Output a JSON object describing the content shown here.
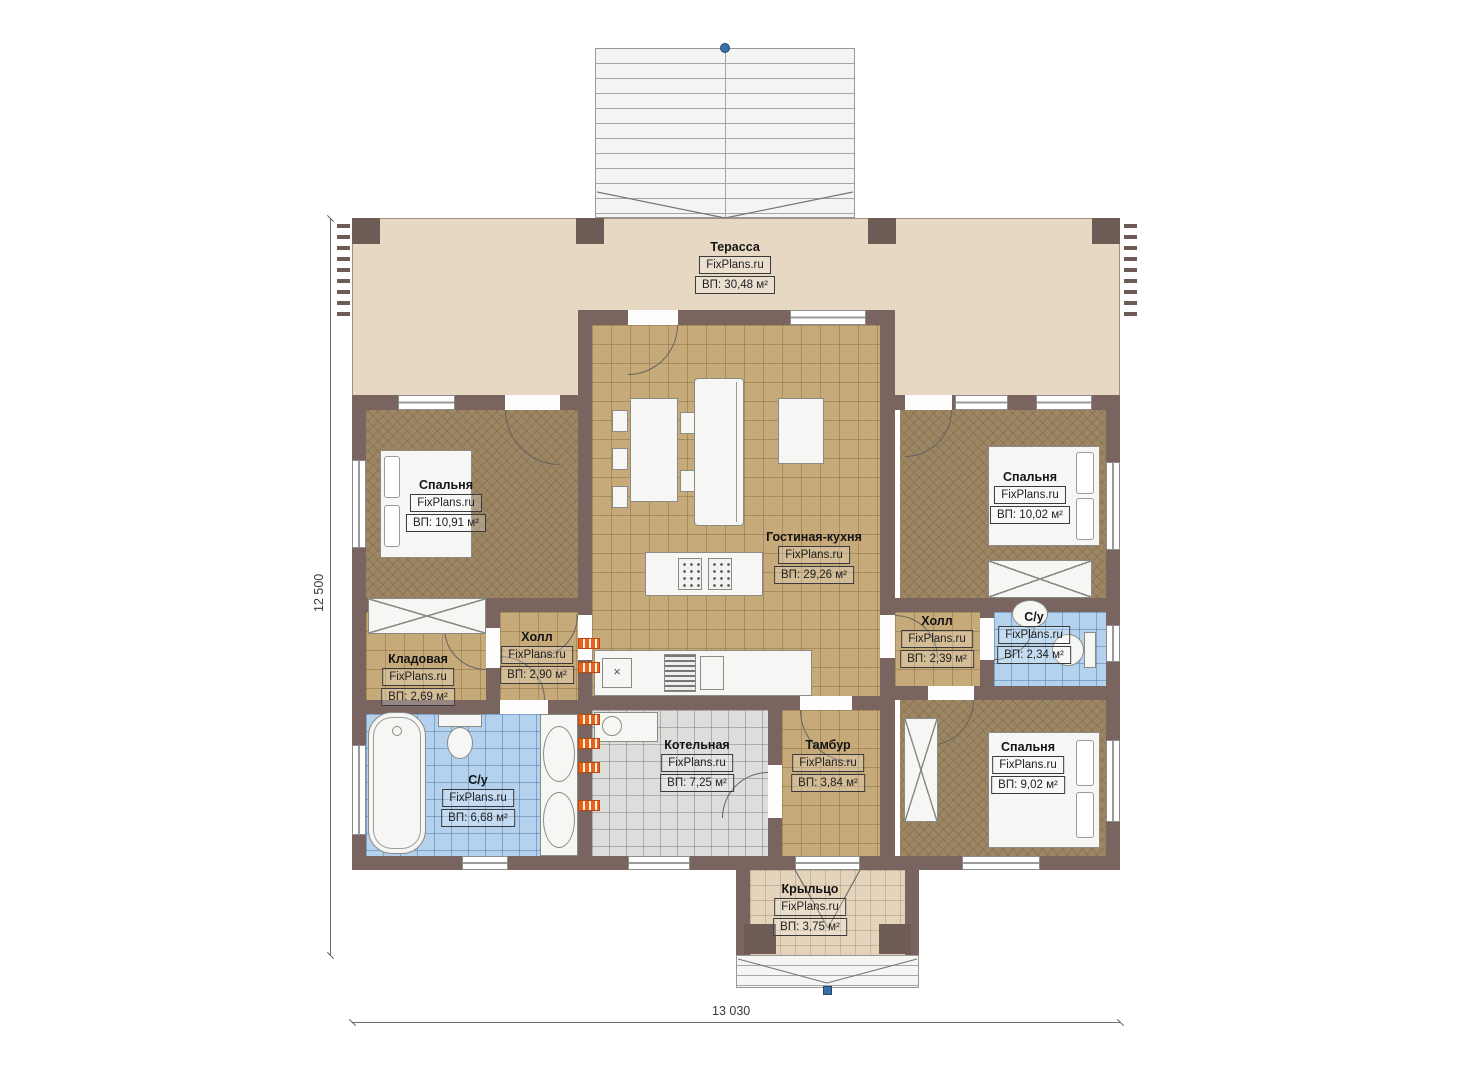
{
  "plan": {
    "watermark": "FixPlans.ru",
    "rooms": {
      "terrace": {
        "name": "Терасса",
        "area": "ВП: 30,48 м²"
      },
      "bedroom_left": {
        "name": "Спальня",
        "area": "ВП: 10,91 м²"
      },
      "bedroom_right": {
        "name": "Спальня",
        "area": "ВП: 10,02 м²"
      },
      "living_kitchen": {
        "name": "Гостиная-кухня",
        "area": "ВП: 29,26 м²"
      },
      "hall_left": {
        "name": "Холл",
        "area": "ВП: 2,90 м²"
      },
      "storage": {
        "name": "Кладовая",
        "area": "ВП: 2,69 м²"
      },
      "bath_left": {
        "name": "С/у",
        "area": "ВП: 6,68 м²"
      },
      "boiler": {
        "name": "Котельная",
        "area": "ВП: 7,25 м²"
      },
      "vestibule": {
        "name": "Тамбур",
        "area": "ВП: 3,84 м²"
      },
      "hall_right": {
        "name": "Холл",
        "area": "ВП: 2,39 м²"
      },
      "bath_right": {
        "name": "С/у",
        "area": "ВП: 2,34 м²"
      },
      "bedroom_bottom": {
        "name": "Спальня",
        "area": "ВП: 9,02 м²"
      },
      "porch": {
        "name": "Крыльцо",
        "area": "ВП: 3,75 м²"
      }
    },
    "dimensions": {
      "height": "12 500",
      "width": "13 030"
    },
    "colors": {
      "wall": "#796460",
      "terrace_floor": "#e6d8c2",
      "tile_tan": "#c7aa79",
      "floor_brown": "#9c8663",
      "tile_blue": "#b4d2ee",
      "tile_gray": "#dddddc",
      "radiator": "#e8621a",
      "marker_blue": "#3a6fa8"
    }
  }
}
